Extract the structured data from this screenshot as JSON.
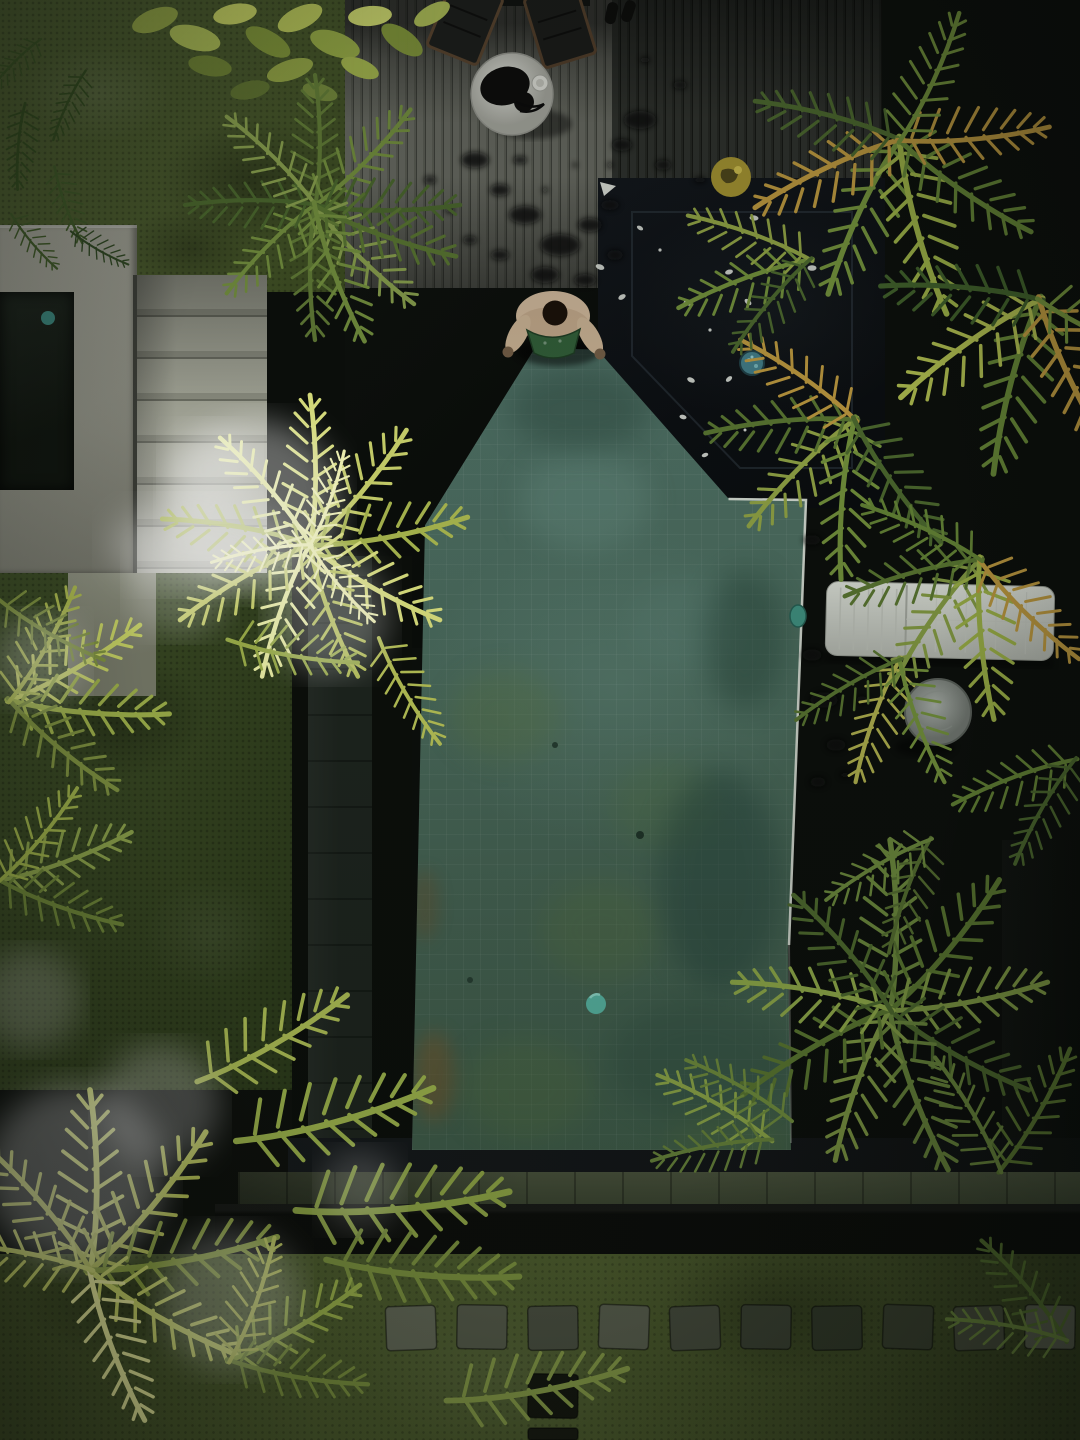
{
  "meta": {
    "title": "Aerial drone view of a tropical villa garden with pool",
    "description": "Top-down photograph: moody dark-toned villa courtyard with a green stone-tiled pool, dark wooden decks, palm trees, mossy lawns and stepping stones.",
    "domain": "photograph",
    "text_content": "none"
  },
  "palette": {
    "pool_water": "#49695b",
    "pool_moss": "#5a7440",
    "deck_gray": "#565850",
    "deck_dark": "#1e211c",
    "lawn": "#4e5e2e",
    "palm_bright": "#dce27f",
    "palm_green": "#6d8a39",
    "palm_dried": "#b3913c",
    "concrete": "#898a7f",
    "cushion": "#c3c7bf",
    "accent_teal": "#3f7680",
    "accent_yellow": "#9c8c2f"
  },
  "scene": {
    "regions": {
      "grass_topleft": {
        "label": "mossy lawn, upper left"
      },
      "deck_gray": {
        "label": "gray timber deck with chairs and wet splashes"
      },
      "deck_darktop": {
        "label": "dark timber deck, upper right"
      },
      "dark_section": {
        "label": "black tiled spa section with scattered white petals"
      },
      "pool": {
        "label": "green stone-tiled swimming pool"
      },
      "deck_lounge": {
        "label": "dark deck with sun lounger and side table"
      },
      "lawn": {
        "label": "lower lawn with stepping stones"
      },
      "concrete": {
        "label": "concrete pavilion roof"
      },
      "steps": {
        "label": "stone steps"
      }
    },
    "objects": {
      "person": {
        "label": "man crouching at pool edge",
        "shorts_color": "green"
      },
      "pouf": {
        "label": "round white pouf with black tray and cup"
      },
      "chairs": {
        "label": "two dark wooden chairs at table"
      },
      "sandals": {
        "label": "pair of black sandals on deck"
      },
      "lounger": {
        "label": "white tufted sun-lounger cushion"
      },
      "side_table": {
        "label": "round concrete side table"
      },
      "yellow_float": {
        "label": "yellow ball at spa edge"
      },
      "mosaic_drain": {
        "label": "round blue mosaic spa light"
      },
      "pool_ball": {
        "label": "small teal ball floating in pool"
      },
      "petals": {
        "label": "white frangipani petals on dark tiles"
      },
      "stepping_stones": {
        "label": "row of square stepping stones in lawn"
      },
      "palms": {
        "label": "overhanging palm canopies, bright and golden fronds"
      }
    }
  }
}
